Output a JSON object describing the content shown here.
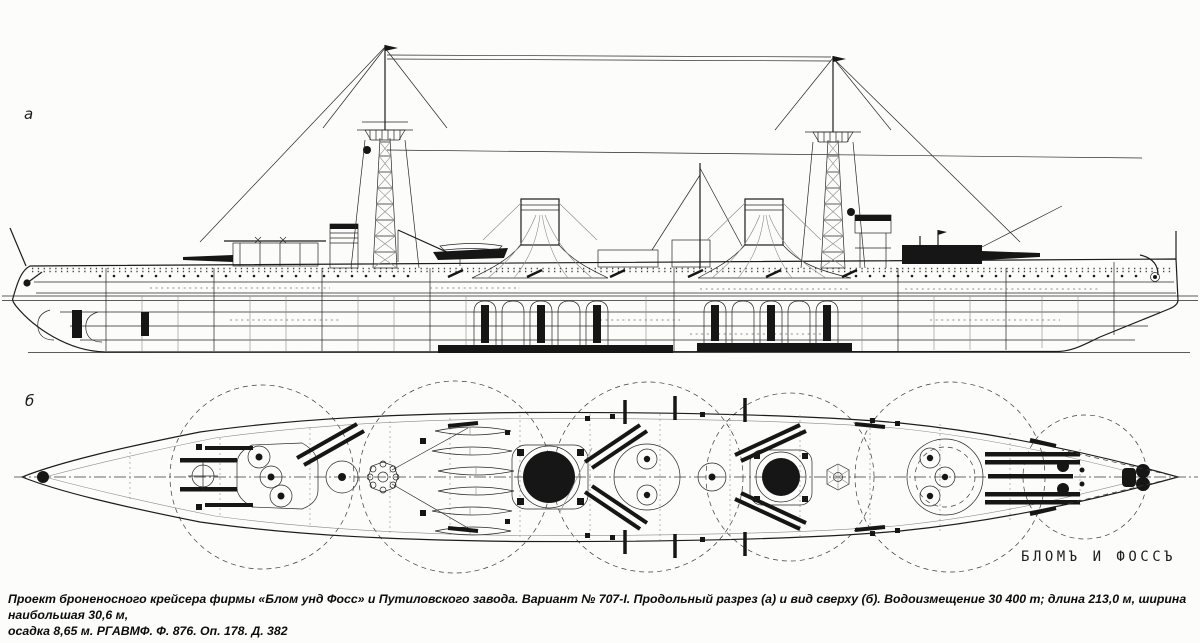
{
  "figure": {
    "type": "warship blueprint, longitudinal section and deck plan",
    "label_a": "а",
    "label_b": "б",
    "stamp": "БЛОМЪ И ФОССЪ",
    "ink_color": "#262626",
    "paper_color": "#fcfcfb"
  },
  "caption": {
    "line1": "Проект броненосного крейсера фирмы «Блом унд Фосс» и Путиловского завода. Вариант № 707-I. Продольный разрез (а) и вид сверху (б). Водоизмещение 30 400 т; длина 213,0 м, ширина наибольшая 30,6 м,",
    "line2": "осадка 8,65 м. РГАВМФ. Ф. 876. Оп. 178. Д. 382"
  }
}
